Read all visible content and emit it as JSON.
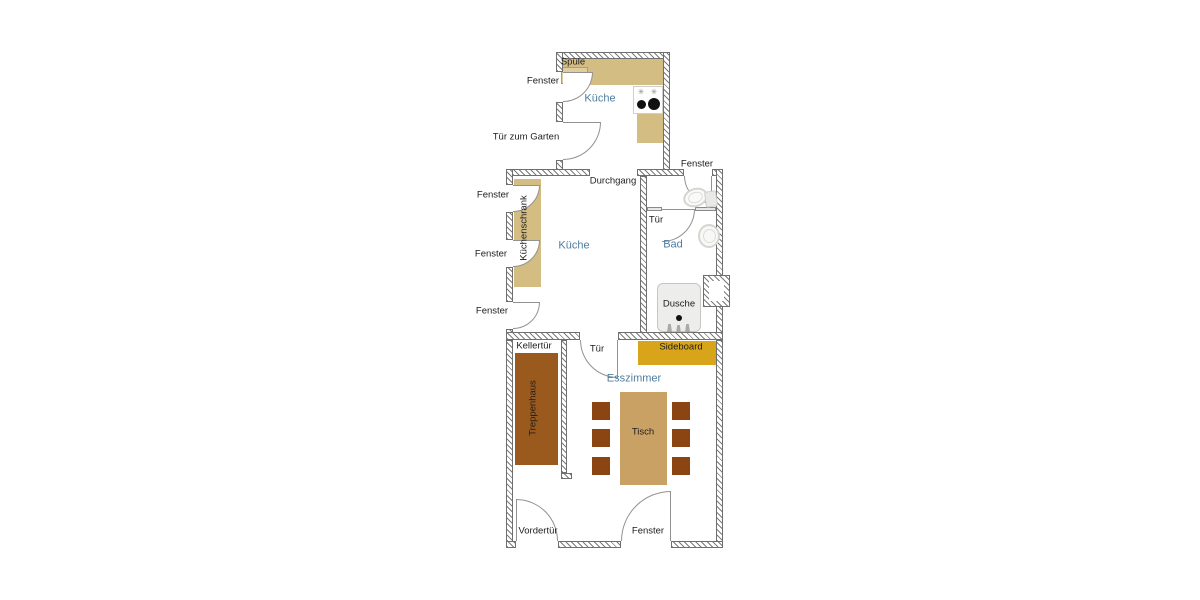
{
  "diagram": {
    "type": "floor-plan",
    "language": "de"
  },
  "rooms": {
    "kueche_annex": "Küche",
    "kueche": "Küche",
    "bad": "Bad",
    "esszimmer": "Esszimmer"
  },
  "openings": {
    "fenster_annex": "Fenster",
    "tuer_garten": "Tür zum Garten",
    "durchgang": "Durchgang",
    "fenster_bad": "Fenster",
    "fenster_1": "Fenster",
    "fenster_2": "Fenster",
    "fenster_3": "Fenster",
    "tuer_bad": "Tür",
    "kellertuer": "Kellertür",
    "tuer_esszimmer": "Tür",
    "vordertuer": "Vordertür",
    "fenster_unten": "Fenster"
  },
  "furniture": {
    "spuele": "Spüle",
    "kuechenschrank": "Küchenschrank",
    "sideboard": "Sideboard",
    "treppenhaus": "Treppenhaus",
    "tisch": "Tisch",
    "dusche": "Dusche"
  },
  "colors": {
    "counter_tan": "#D3BD82",
    "sink_unit": "#DFCD9C",
    "sideboard_gold": "#D8A41A",
    "treppenhaus_brown": "#9A5A1E",
    "tisch_tan": "#C9A164",
    "chair_brown": "#8B4513",
    "room_label_blue": "#4E7DA1",
    "shower_gray": "#EDEDEB"
  }
}
